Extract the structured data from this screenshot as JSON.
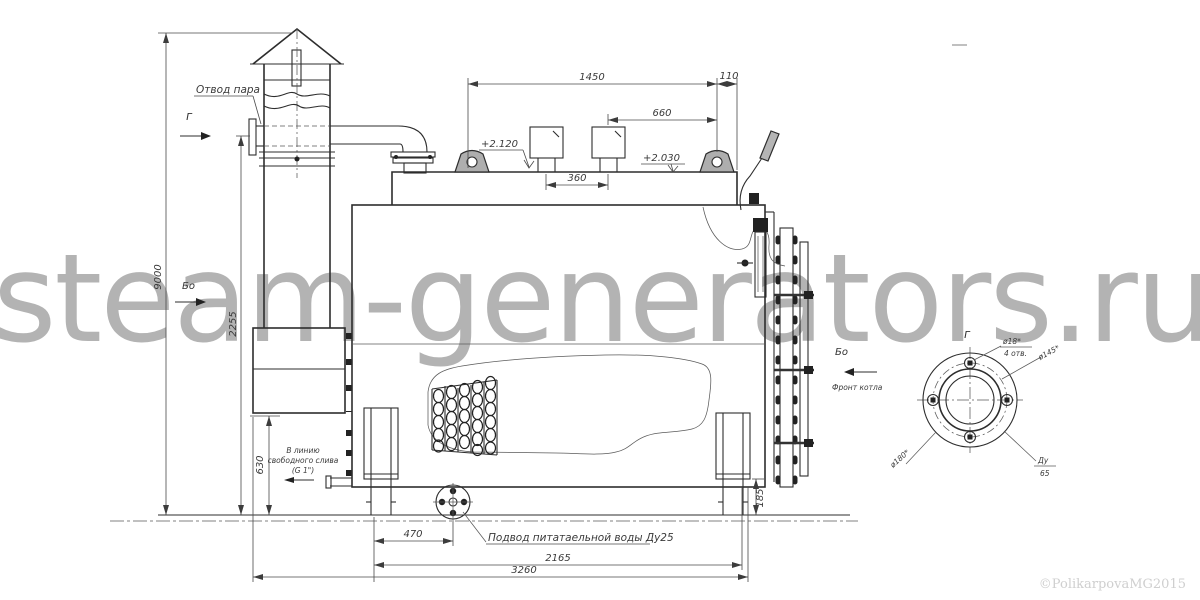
{
  "watermark": {
    "text": "steam-generators.ru",
    "color": "#b3b3b3"
  },
  "copyright": "©PolikarpovaMG2015",
  "labels": {
    "steam_outlet": "Отвод пара",
    "level_top": "+2.120",
    "level_mid": "+2.030",
    "view_g": "г",
    "view_bo": "Бо",
    "view_bo_front": "Бо",
    "front_of_boiler": "Фронт котла",
    "drain_l1": "В линию",
    "drain_l2": "свободного слива",
    "drain_l3": "(G 1\")",
    "feed_water": "Подвод питатаельной воды Ду25"
  },
  "dims": {
    "w1450": "1450",
    "w110": "110",
    "w660": "660",
    "w360": "360",
    "h9000": "9000",
    "h2255": "2255",
    "h630": "630",
    "h185": "185",
    "w470": "470",
    "w2165": "2165",
    "w3260": "3260"
  },
  "flange": {
    "view_label": "г",
    "hole_dia": "ø18*",
    "hole_count": "4 отв.",
    "bolt_circle": "ø145*",
    "outer_dia": "ø180*",
    "dn_top": "Ду",
    "dn_bottom": "65"
  }
}
